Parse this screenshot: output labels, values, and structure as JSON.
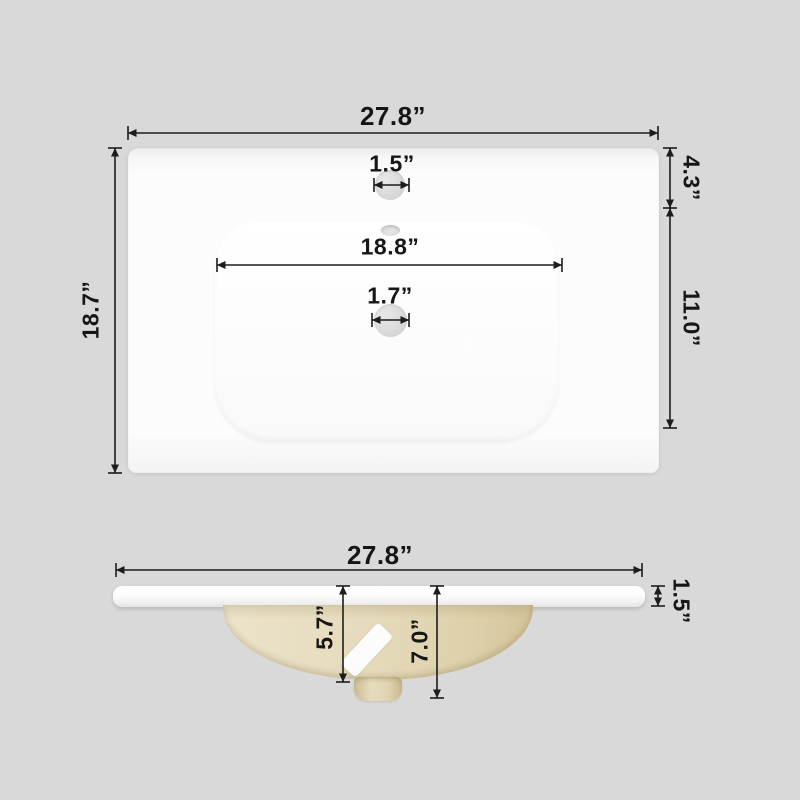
{
  "diagram": {
    "dims": {
      "top": {
        "width": "27.8”",
        "depth": "18.7”",
        "faucet_hole": "1.5”",
        "edge_to_faucet": "4.3”",
        "basin_width": "18.8”",
        "drain_hole": "1.7”",
        "faucet_to_basin_front": "11.0”"
      },
      "side": {
        "width": "27.8”",
        "countertop_thickness": "1.5”",
        "bowl_depth": "5.7”",
        "total_depth": "7.0”"
      }
    },
    "colors": {
      "background": "#d9d9d9",
      "ceramic_white": "#fcfcfc",
      "bowl_tan": "#e4d8b8",
      "dimension_line": "#1c1c1c"
    }
  }
}
